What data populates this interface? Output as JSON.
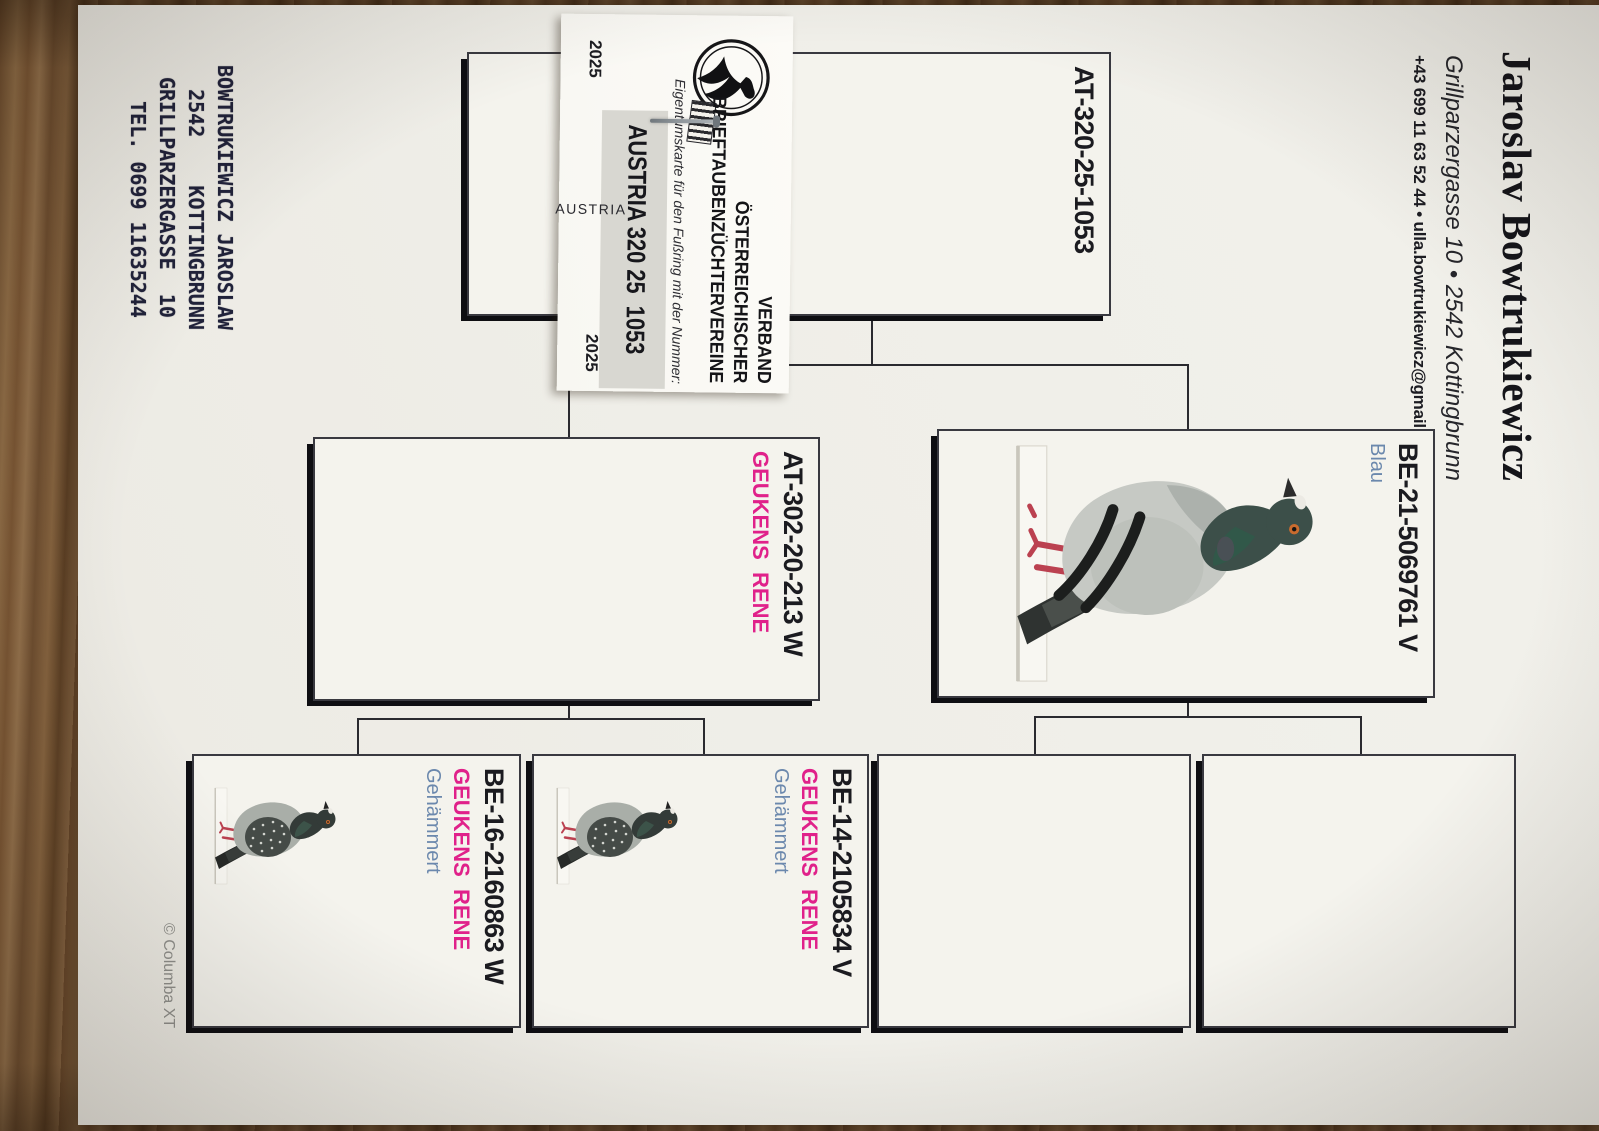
{
  "header": {
    "name": "Jaroslav Bowtrukiewicz",
    "address_line": "Grillparzergasse 10 • 2542 Kottingbrunn",
    "contact_line": "+43 699 11 63 52 44 • ulla.bowtrukiewicz@gmail.com"
  },
  "ownership_card": {
    "org_lines": [
      "VERBAND",
      "ÖSTERREICHISCHER",
      "BRIEFTAUBENZÜCHTERVEREINE"
    ],
    "caption": "Eigentumskarte für den Fußring mit der Nummer:",
    "ring_number": "AUSTRIA 320 25  1053",
    "country": "AUSTRIA",
    "year_left": "2025",
    "year_right": "2025"
  },
  "pedigree": {
    "subject": {
      "ring": "AT-320-25-1053"
    },
    "father": {
      "ring": "BE-21-5069761 V",
      "color": "Blau"
    },
    "mother": {
      "ring": "AT-302-20-213 W",
      "breeder": "GEUKENS  RENE"
    },
    "fathers_father": {
      "ring": ""
    },
    "fathers_mother": {
      "ring": ""
    },
    "mothers_father": {
      "ring": "BE-14-2105834 V",
      "breeder": "GEUKENS  RENE",
      "color": "Gehämmert"
    },
    "mothers_mother": {
      "ring": "BE-16-2160863 W",
      "breeder": "GEUKENS  RENE",
      "color": "Gehämmert"
    }
  },
  "stamp": {
    "lines": [
      "BOWTRUKIEWICZ JAROSLAW",
      "  2542    KOTTINGBRUNN",
      " GRILLPARZERGASSE  10",
      "   TEL. 0699 11635244"
    ]
  },
  "watermark": "© Columba XT",
  "colors": {
    "magenta": "#e0218a",
    "blue": "#6b88ad"
  }
}
